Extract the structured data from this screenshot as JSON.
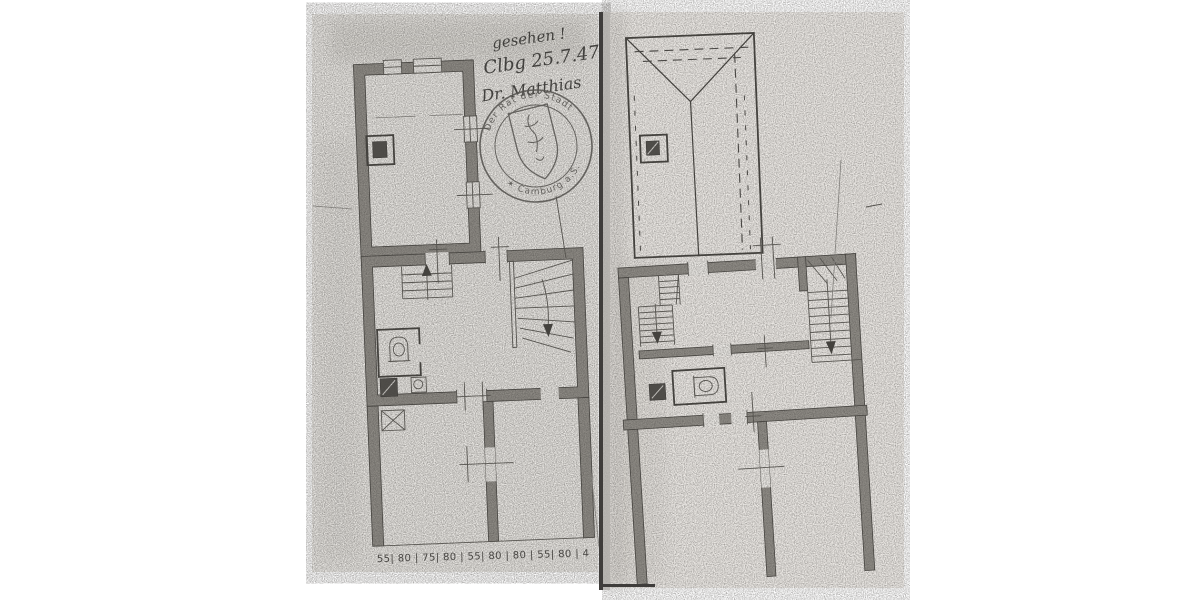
{
  "handwritten_note": {
    "line1": "gesehen !",
    "line2": "Clbg 25.7.47",
    "line3": "Dr. Matthias"
  },
  "stamp": {
    "arc_top": "Der Rat der Stadt",
    "arc_bottom": "✶ Camburg a.S.",
    "ink": "#5b5955"
  },
  "dimension_chain": {
    "text": "55| 80 | 75| 80 | 55| 80 | 80 | 55| 80 | 4"
  },
  "colors": {
    "paper_left": "#ebe9e5",
    "paper_right": "#edeae6",
    "ink": "#44423e",
    "wall_fill": "#8f8c86",
    "page_edge": "#3f3d3b"
  },
  "symbols": {
    "toilet": "wc-toilet-plan-symbol",
    "chimney": "chimney-flue-square",
    "stair_arrow": "stair-direction-arrow",
    "window": "double-line-window",
    "roof": "hipped-roof-plan-with-dashed-eaves",
    "seal": "round-municipal-seal-with-shield"
  }
}
